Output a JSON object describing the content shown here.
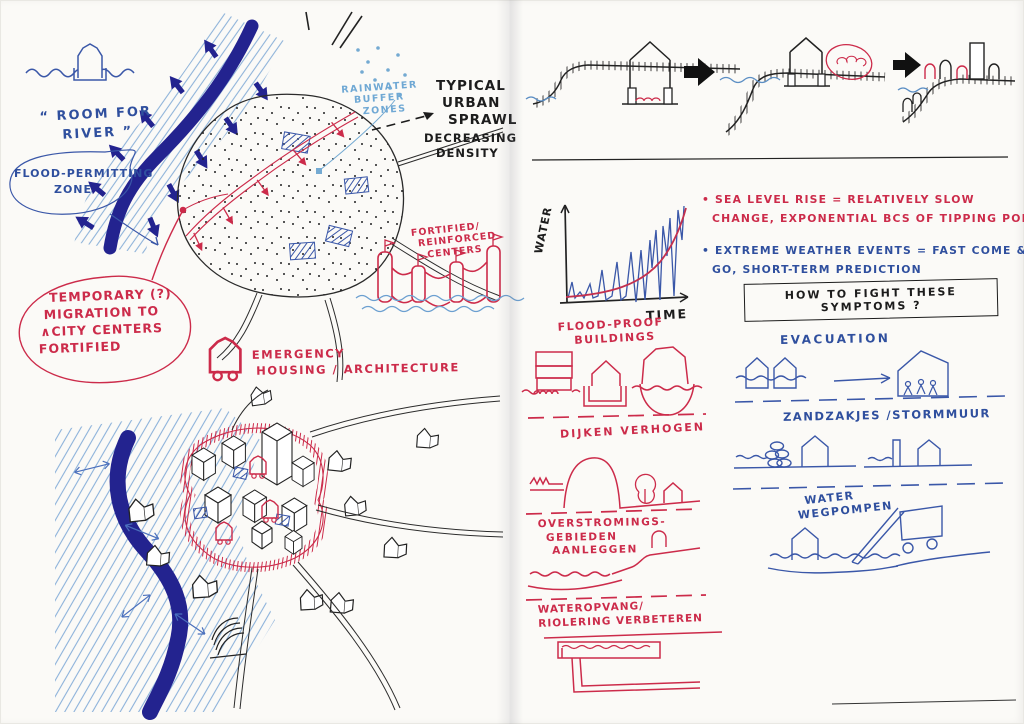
{
  "colors": {
    "navy": "#23238f",
    "blue_ink": "#2f4f9e",
    "light_blue": "#6fa8d4",
    "red_ink": "#cc2b4a",
    "black_ink": "#1c1c1c"
  },
  "left_page": {
    "room_for_river": {
      "line1": "“ ROOM FOR",
      "line2": "RIVER ”"
    },
    "flood_zone_bubble": {
      "line1": "FLOOD-PERMITTING",
      "line2": "ZONE"
    },
    "rainwater": {
      "line1": "RAINWATER",
      "line2": "BUFFER",
      "line3": "ZONES"
    },
    "urban_sprawl": {
      "line1": "TYPICAL",
      "line2": "URBAN",
      "line3": "SPRAWL"
    },
    "density": {
      "line1": "DECREASING",
      "line2": "DENSITY"
    },
    "fortified_centers": {
      "line1": "FORTIFIED/",
      "line2": "REINFORCED",
      "line3": "CENTERS"
    },
    "migration_bubble": {
      "line1": "TEMPORARY (?)",
      "line2": "MIGRATION TO",
      "line3": "∧CITY CENTERS",
      "line4": "FORTIFIED"
    },
    "emergency": {
      "line1": "EMERGENCY",
      "line2": "HOUSING / ARCHITECTURE"
    }
  },
  "right_page": {
    "graph": {
      "y_label": "WATER",
      "x_label": "TIME"
    },
    "notes": {
      "sea_level": {
        "line1": "• SEA LEVEL RISE = RELATIVELY SLOW",
        "line2": "CHANGE, EXPONENTIAL BCS OF TIPPING POINTS"
      },
      "extreme": {
        "line1": "• EXTREME WEATHER EVENTS = FAST COME &",
        "line2": "GO, SHORT-TERM PREDICTION"
      }
    },
    "symptoms_box": "HOW TO FIGHT THESE SYMPTOMS ?",
    "measures_red": {
      "flood_proof": {
        "line1": "FLOOD-PROOF",
        "line2": "BUILDINGS"
      },
      "dijken": "DIJKEN VERHOGEN",
      "overstromings": {
        "line1": "OVERSTROMINGS-",
        "line2": "GEBIEDEN",
        "line3": "AANLEGGEN"
      },
      "wateropvang": {
        "line1": "WATEROPVANG/",
        "line2": "RIOLERING VERBETEREN"
      }
    },
    "measures_blue": {
      "evacuation": "EVACUATION",
      "zandzakjes": "ZANDZAKJES /STORMMUUR",
      "wegpompen": {
        "line1": "WATER",
        "line2": "WEGPOMPEN"
      }
    }
  },
  "pictograms": {
    "floating_house": "house floating on water",
    "river_flood_band": "river with flood-permitting hatched zone and outward arrows",
    "city_zone": "dotted city area with hatched buildings and red fortification edge",
    "castle": "fortified castle with flags in water",
    "mobile_house": "emergency house on wheels",
    "iso_city": "isometric fortified city by river",
    "cliff_sequence": "house on coast losing ground to sea, densifying on high ground",
    "water_time_graph": "spiky water level over time with exponential trend"
  }
}
